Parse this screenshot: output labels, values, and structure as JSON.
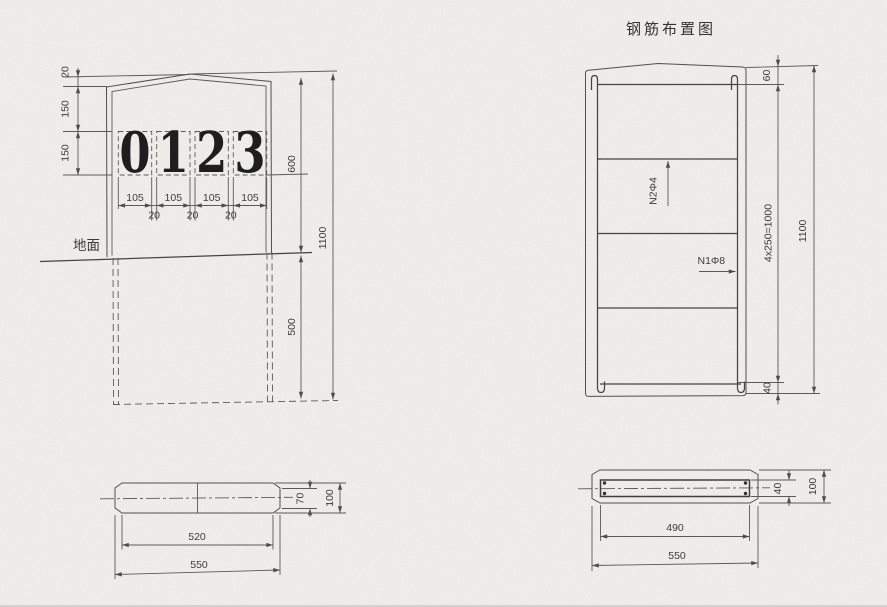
{
  "title": "钢筋布置图",
  "elevation": {
    "digits": [
      "0",
      "1",
      "2",
      "3"
    ],
    "ground_label": "地面",
    "dims": {
      "cap": "20",
      "cap_to_digits": "150",
      "digit_height": "150",
      "digit_widths": [
        "105",
        "105",
        "105",
        "105"
      ],
      "digit_gaps": [
        "20",
        "20",
        "20"
      ],
      "above_ground": "600",
      "below_ground": "500",
      "total": "1100"
    }
  },
  "post_section": {
    "dims": {
      "face": "70",
      "height": "100",
      "inner_width": "520",
      "width": "550"
    }
  },
  "rebar": {
    "bar_labels": {
      "distribution": "N2Φ4",
      "main": "N1Φ8"
    },
    "dims": {
      "top_cover": "60",
      "spacing": "4x250=1000",
      "total": "1100",
      "bottom_cover": "40"
    }
  },
  "rebar_section": {
    "dims": {
      "cage_height": "40",
      "height": "100",
      "cage_width": "490",
      "width": "550"
    }
  }
}
